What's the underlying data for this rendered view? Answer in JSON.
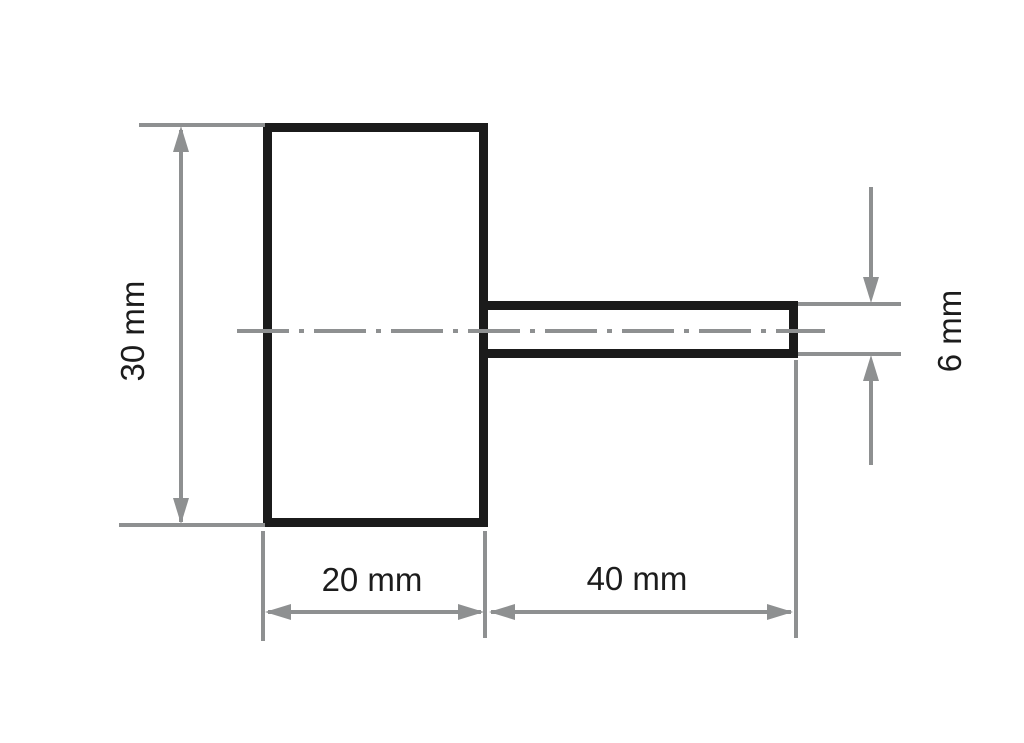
{
  "drawing": {
    "kind": "technical-dimension-drawing",
    "part": "cylindrical body with shaft",
    "background_color": "#ffffff",
    "outline_color": "#1b1b1b",
    "dimension_color": "#8e9091",
    "text_color": "#1c1c1c",
    "dimensions": {
      "body_height": {
        "label": "30 mm",
        "value": 30,
        "unit": "mm",
        "orientation": "vertical"
      },
      "body_width": {
        "label": "20 mm",
        "value": 20,
        "unit": "mm",
        "orientation": "horizontal"
      },
      "shaft_length": {
        "label": "40 mm",
        "value": 40,
        "unit": "mm",
        "orientation": "horizontal"
      },
      "shaft_diameter": {
        "label": "6 mm",
        "value": 6,
        "unit": "mm",
        "orientation": "vertical"
      }
    }
  }
}
